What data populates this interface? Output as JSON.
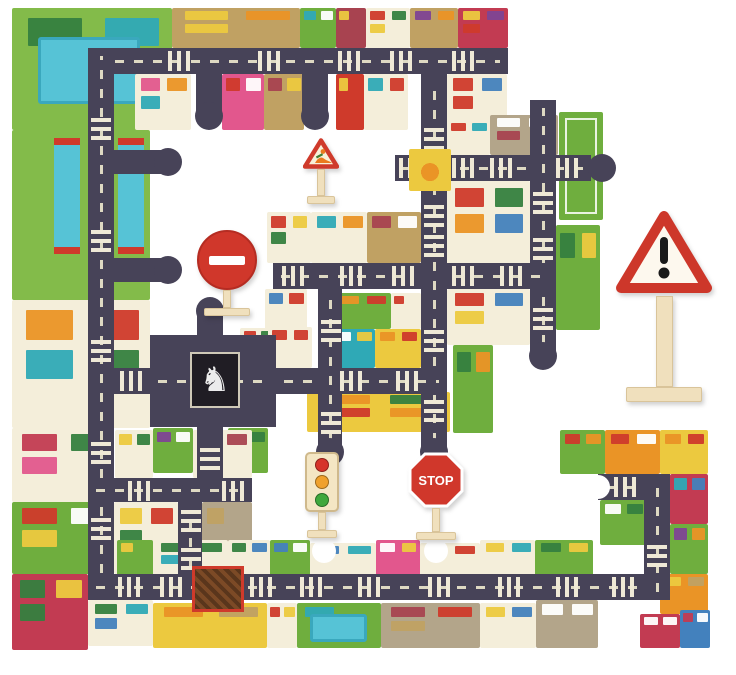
{
  "meta": {
    "description": "Children's giant city puzzle mat: jigsaw pieces forming roads and city blocks, with wooden traffic signs (roadworks, no-entry, traffic light, stop, large warning sign).",
    "background_color": "#ffffff"
  },
  "palette": {
    "road": "#474358",
    "dash": "#ded9c3",
    "g": "#83bb4a",
    "g2": "#6fae3e",
    "cr": "#f4eeda",
    "tn": "#c0a163",
    "tg": "#b3a58a",
    "yl": "#ecc93f",
    "rd": "#cf3a2b",
    "mr": "#a84350",
    "pk": "#e2578d",
    "or": "#ea9426",
    "tl": "#2fa9b6",
    "pu": "#7e4494",
    "bl": "#4381bd",
    "dg": "#35803f",
    "wh": "#ffffff",
    "pool": "#56c3d6",
    "crimson": "#c23b52"
  },
  "scene": {
    "width": 736,
    "height": 675,
    "blocks_format": "[x,y,w,h,colorKey,[accentKeys],pattern?] pattern in {pool,bridge,field}",
    "blocks": [
      [
        12,
        8,
        160,
        122,
        "g",
        [
          "dg",
          "tl"
        ],
        "pool"
      ],
      [
        172,
        8,
        128,
        40,
        "tn",
        [
          "yl",
          "or",
          "yl"
        ]
      ],
      [
        300,
        8,
        36,
        40,
        "g2",
        [
          "tl",
          "wh"
        ]
      ],
      [
        336,
        8,
        30,
        40,
        "mr",
        [
          "yl"
        ]
      ],
      [
        366,
        8,
        44,
        40,
        "cr",
        [
          "rd",
          "dg",
          "yl"
        ]
      ],
      [
        410,
        8,
        48,
        40,
        "tn",
        [
          "pu",
          "or"
        ]
      ],
      [
        458,
        8,
        50,
        40,
        "crimson",
        [
          "yl",
          "pu",
          "rd"
        ]
      ],
      [
        135,
        74,
        56,
        56,
        "cr",
        [
          "pk",
          "or",
          "tl"
        ]
      ],
      [
        222,
        74,
        42,
        56,
        "pk",
        [
          "rd",
          "wh"
        ]
      ],
      [
        264,
        74,
        40,
        56,
        "tn",
        [
          "mr",
          "yl"
        ]
      ],
      [
        336,
        74,
        28,
        56,
        "rd",
        [
          "yl"
        ]
      ],
      [
        364,
        74,
        44,
        56,
        "cr",
        [
          "tl",
          "rd"
        ]
      ],
      [
        447,
        74,
        60,
        56,
        "cr",
        [
          "rd",
          "bl",
          "rd"
        ]
      ],
      [
        447,
        120,
        43,
        35,
        "cr",
        [
          "rd",
          "tl"
        ]
      ],
      [
        490,
        115,
        68,
        40,
        "tg",
        [
          "wh",
          "wh",
          "mr"
        ]
      ],
      [
        559,
        112,
        44,
        108,
        "g2",
        [],
        "field"
      ],
      [
        447,
        181,
        83,
        84,
        "cr",
        [
          "rd",
          "dg",
          "or",
          "bl"
        ]
      ],
      [
        556,
        225,
        44,
        105,
        "g2",
        [
          "dg",
          "yl"
        ]
      ],
      [
        447,
        289,
        83,
        56,
        "cr",
        [
          "rd",
          "bl",
          "yl"
        ]
      ],
      [
        453,
        345,
        40,
        88,
        "g2",
        [
          "dg",
          "or"
        ]
      ],
      [
        267,
        212,
        44,
        51,
        "cr",
        [
          "rd",
          "yl",
          "dg"
        ]
      ],
      [
        311,
        212,
        56,
        51,
        "cr",
        [
          "tl",
          "or"
        ]
      ],
      [
        367,
        212,
        54,
        51,
        "tn",
        [
          "mr",
          "wh"
        ]
      ],
      [
        265,
        289,
        42,
        48,
        "cr",
        [
          "bl",
          "rd"
        ]
      ],
      [
        240,
        328,
        36,
        40,
        "cr",
        [
          "rd",
          "dg"
        ]
      ],
      [
        333,
        293,
        58,
        36,
        "g2",
        [
          "or",
          "rd"
        ]
      ],
      [
        391,
        293,
        30,
        36,
        "cr",
        [
          "rd"
        ]
      ],
      [
        333,
        329,
        42,
        39,
        "tl",
        [
          "wh",
          "yl"
        ]
      ],
      [
        375,
        329,
        46,
        39,
        "yl",
        [
          "or",
          "rd"
        ]
      ],
      [
        268,
        327,
        44,
        41,
        "cr",
        [
          "rd",
          "rd"
        ]
      ],
      [
        153,
        428,
        40,
        45,
        "g2",
        [
          "pu",
          "wh"
        ]
      ],
      [
        228,
        428,
        40,
        45,
        "g2",
        [
          "wh",
          "dg"
        ]
      ],
      [
        307,
        392,
        143,
        40,
        "yl",
        [
          "or",
          "dg",
          "rd",
          "or"
        ]
      ],
      [
        115,
        430,
        38,
        48,
        "cr",
        [
          "yl",
          "dg"
        ]
      ],
      [
        193,
        430,
        59,
        48,
        "cr",
        [
          "dg",
          "mr"
        ]
      ],
      [
        114,
        502,
        64,
        72,
        "cr",
        [
          "yl",
          "rd",
          "dg"
        ]
      ],
      [
        202,
        502,
        50,
        72,
        "tg",
        [
          "tn"
        ]
      ],
      [
        12,
        130,
        138,
        170,
        "g",
        [],
        "bridge"
      ],
      [
        12,
        300,
        138,
        128,
        "cr",
        [
          "or",
          "rd",
          "tl",
          "dg"
        ]
      ],
      [
        12,
        428,
        102,
        74,
        "cr",
        [
          "crimson",
          "dg",
          "pk"
        ]
      ],
      [
        12,
        502,
        102,
        72,
        "g2",
        [
          "rd",
          "wh",
          "yl"
        ]
      ],
      [
        12,
        574,
        76,
        76,
        "crimson",
        [
          "dg",
          "yl",
          "dg"
        ]
      ],
      [
        117,
        540,
        36,
        38,
        "g2",
        [
          "yl"
        ]
      ],
      [
        153,
        540,
        75,
        38,
        "cr",
        [
          "dg",
          "dg",
          "tl"
        ]
      ],
      [
        228,
        540,
        42,
        38,
        "cr",
        [
          "dg",
          "bl"
        ]
      ],
      [
        270,
        540,
        40,
        38,
        "g2",
        [
          "bl",
          "wh"
        ]
      ],
      [
        310,
        543,
        66,
        35,
        "cr",
        [
          "bl",
          "tl"
        ]
      ],
      [
        376,
        540,
        44,
        38,
        "pk",
        [
          "wh",
          "yl"
        ]
      ],
      [
        420,
        543,
        60,
        35,
        "cr",
        [
          "or",
          "rd"
        ]
      ],
      [
        480,
        540,
        55,
        38,
        "cr",
        [
          "yl",
          "tl"
        ]
      ],
      [
        535,
        540,
        58,
        38,
        "g2",
        [
          "dg",
          "yl"
        ]
      ],
      [
        88,
        600,
        65,
        46,
        "cr",
        [
          "dg",
          "tl",
          "bl"
        ]
      ],
      [
        153,
        603,
        114,
        45,
        "yl",
        [
          "or",
          "tn"
        ]
      ],
      [
        267,
        603,
        30,
        45,
        "cr",
        [
          "rd",
          "yl"
        ]
      ],
      [
        297,
        603,
        84,
        45,
        "g2",
        [
          "tl"
        ],
        "pool"
      ],
      [
        381,
        603,
        99,
        45,
        "tg",
        [
          "mr",
          "rd",
          "tn"
        ]
      ],
      [
        480,
        603,
        56,
        45,
        "cr",
        [
          "yl",
          "bl"
        ]
      ],
      [
        536,
        600,
        62,
        48,
        "tg",
        [
          "wh",
          "wh"
        ]
      ],
      [
        560,
        430,
        45,
        44,
        "g2",
        [
          "rd",
          "or"
        ]
      ],
      [
        605,
        430,
        55,
        44,
        "or",
        [
          "rd",
          "wh"
        ]
      ],
      [
        660,
        430,
        48,
        44,
        "yl",
        [
          "or",
          "rd"
        ]
      ],
      [
        600,
        500,
        47,
        45,
        "g2",
        [
          "wh",
          "dg"
        ]
      ],
      [
        670,
        474,
        38,
        50,
        "crimson",
        [
          "tl",
          "bl"
        ]
      ],
      [
        670,
        524,
        38,
        50,
        "g2",
        [
          "pu",
          "or"
        ]
      ],
      [
        660,
        574,
        48,
        40,
        "or",
        [
          "yl",
          "tn"
        ]
      ],
      [
        640,
        614,
        40,
        34,
        "crimson",
        [
          "wh",
          "wh"
        ]
      ],
      [
        680,
        610,
        30,
        38,
        "bl",
        [
          "crimson",
          "wh"
        ]
      ]
    ],
    "roads_format": "[x,y,w,h]",
    "roads": [
      [
        88,
        48,
        420,
        26
      ],
      [
        88,
        48,
        26,
        552
      ],
      [
        88,
        574,
        582,
        26
      ],
      [
        114,
        150,
        48,
        24
      ],
      [
        114,
        258,
        48,
        24
      ],
      [
        196,
        74,
        26,
        38
      ],
      [
        302,
        74,
        26,
        38
      ],
      [
        421,
        74,
        26,
        376
      ],
      [
        395,
        155,
        196,
        26
      ],
      [
        530,
        100,
        26,
        252
      ],
      [
        447,
        263,
        109,
        26
      ],
      [
        273,
        263,
        148,
        26
      ],
      [
        276,
        368,
        171,
        26
      ],
      [
        114,
        368,
        36,
        26
      ],
      [
        150,
        335,
        126,
        92
      ],
      [
        197,
        315,
        26,
        20
      ],
      [
        197,
        427,
        26,
        51
      ],
      [
        88,
        478,
        164,
        24
      ],
      [
        178,
        502,
        24,
        72
      ],
      [
        318,
        289,
        24,
        161
      ],
      [
        598,
        474,
        72,
        26
      ],
      [
        644,
        474,
        26,
        126
      ]
    ],
    "crosswalks_format": "[x,y,orientation h|v]",
    "crosswalks": [
      [
        168,
        51,
        "h"
      ],
      [
        258,
        51,
        "h"
      ],
      [
        338,
        51,
        "h"
      ],
      [
        390,
        51,
        "h"
      ],
      [
        452,
        51,
        "h"
      ],
      [
        91,
        118,
        "v"
      ],
      [
        91,
        230,
        "v"
      ],
      [
        91,
        340,
        "v"
      ],
      [
        91,
        442,
        "v"
      ],
      [
        91,
        518,
        "v"
      ],
      [
        118,
        577,
        "h"
      ],
      [
        160,
        577,
        "h"
      ],
      [
        250,
        577,
        "h"
      ],
      [
        300,
        577,
        "h"
      ],
      [
        358,
        577,
        "h"
      ],
      [
        428,
        577,
        "h"
      ],
      [
        498,
        577,
        "h"
      ],
      [
        556,
        577,
        "h"
      ],
      [
        612,
        577,
        "h"
      ],
      [
        399,
        158,
        "h"
      ],
      [
        452,
        158,
        "h"
      ],
      [
        490,
        158,
        "h"
      ],
      [
        556,
        158,
        "h"
      ],
      [
        533,
        192,
        "v"
      ],
      [
        533,
        238,
        "v"
      ],
      [
        533,
        308,
        "v"
      ],
      [
        452,
        266,
        "h"
      ],
      [
        500,
        266,
        "h"
      ],
      [
        282,
        266,
        "h"
      ],
      [
        340,
        266,
        "h"
      ],
      [
        392,
        266,
        "h"
      ],
      [
        340,
        371,
        "h"
      ],
      [
        396,
        371,
        "h"
      ],
      [
        120,
        371,
        "h"
      ],
      [
        424,
        128,
        "v"
      ],
      [
        424,
        205,
        "v"
      ],
      [
        424,
        235,
        "v"
      ],
      [
        424,
        330,
        "v"
      ],
      [
        424,
        400,
        "v"
      ],
      [
        321,
        320,
        "v"
      ],
      [
        321,
        412,
        "v"
      ],
      [
        200,
        448,
        "v"
      ],
      [
        128,
        481,
        "h"
      ],
      [
        222,
        481,
        "h"
      ],
      [
        181,
        510,
        "v"
      ],
      [
        181,
        548,
        "v"
      ],
      [
        647,
        545,
        "v"
      ],
      [
        614,
        477,
        "h"
      ]
    ],
    "bulbs_format": "[cx,cy] jigsaw road tabs",
    "bulbs": [
      [
        168,
        162
      ],
      [
        168,
        270
      ],
      [
        209,
        116
      ],
      [
        315,
        116
      ],
      [
        434,
        452
      ],
      [
        330,
        452
      ],
      [
        543,
        356
      ],
      [
        210,
        311
      ],
      [
        602,
        168
      ]
    ],
    "sockets": [
      [
        598,
        487
      ],
      [
        324,
        551
      ],
      [
        436,
        551
      ]
    ],
    "plaza": {
      "x": 409,
      "y": 149,
      "w": 42,
      "h": 42
    },
    "patch": {
      "x": 192,
      "y": 566,
      "w": 46,
      "h": 40
    },
    "statue": {
      "x": 190,
      "y": 352,
      "w": 46,
      "h": 52,
      "glyph": "♞"
    },
    "signs": {
      "roadworks": {
        "x": 303,
        "y": 138,
        "w": 36,
        "h": 66
      },
      "noentry": {
        "x": 197,
        "y": 230,
        "w": 60,
        "h": 86
      },
      "trafficlight": {
        "x": 303,
        "y": 452,
        "w": 38,
        "h": 86,
        "lamp_colors": [
          "#d6342a",
          "#f0a12c",
          "#3fa83c"
        ]
      },
      "stop": {
        "x": 407,
        "y": 452,
        "w": 58,
        "h": 88,
        "label": "STOP"
      },
      "warning": {
        "x": 616,
        "y": 210,
        "w": 96,
        "h": 192,
        "glyph": "!"
      }
    }
  }
}
